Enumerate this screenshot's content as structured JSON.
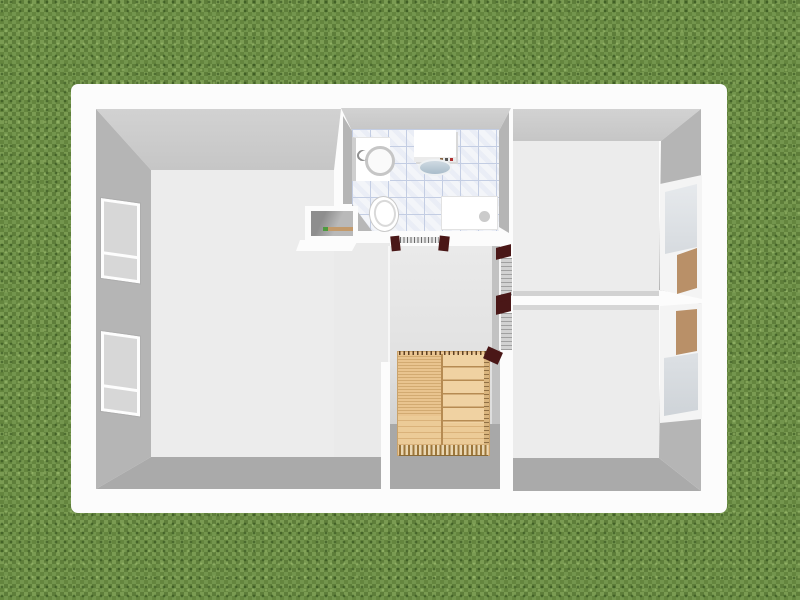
{
  "scene": {
    "description": "Aerial 3D rendering of a house upper-floor plan surrounded by grass",
    "view_type": "aerial-3d",
    "rooms": [
      {
        "name": "large-west-room",
        "position": "left"
      },
      {
        "name": "bathroom",
        "position": "top-center"
      },
      {
        "name": "hallway-stairwell",
        "position": "center"
      },
      {
        "name": "northeast-room",
        "position": "top-right"
      },
      {
        "name": "southeast-room",
        "position": "bottom-right"
      }
    ],
    "objects": [
      "washing-machine",
      "water-heater-with-sink",
      "toilet",
      "shower-tray",
      "wall-niche-shelf",
      "staircase",
      "bathroom-sliding-door",
      "northeast-louvered-door",
      "southeast-louvered-door",
      "west-window-1",
      "west-window-2",
      "east-window-north",
      "east-window-south"
    ]
  },
  "titles": {
    "viewport": "3D aerial view of floor plan",
    "house": "House",
    "west_room": "Large west room",
    "bathroom": "Bathroom",
    "hallway": "Hallway with stairwell",
    "ne_room": "Northeast room",
    "se_room": "Southeast room",
    "washing_machine": "Washing machine",
    "water_heater": "Water heater with sink",
    "toilet": "Toilet",
    "shower": "Shower tray",
    "niche": "Wall niche shelf",
    "stairs": "Staircase",
    "bath_door": "Bathroom sliding door",
    "ne_door": "Northeast room door",
    "se_door": "Southeast room door",
    "window_w1": "West window 1",
    "window_w2": "West window 2",
    "window_en": "East window north",
    "window_es": "East window south"
  },
  "colors": {
    "grass_base": "#6b8c45",
    "slab": "#fcfcfc",
    "wall_face": "#b5b5b5",
    "wall_face_top": "#c6c6c6",
    "wall_face_dark": "#aaaaaa",
    "floor": "#ececec",
    "floor_hall": "#e2e2e2",
    "stairwell_shadow": "#a8a8a8",
    "tile_base": "#f3f5f9",
    "tile_line": "#c3cde3",
    "wood": "#ecc795",
    "wood_dark": "#b68b52",
    "door_frame": "#4a1717",
    "door_panel": "#d2d2d2",
    "window_glass": "#d7d7d7",
    "window_wood": "#b99068",
    "basin": "#a9bcca",
    "shelf_item_green": "#4e9a3f",
    "shelf_item_wood": "#c39a6b"
  }
}
